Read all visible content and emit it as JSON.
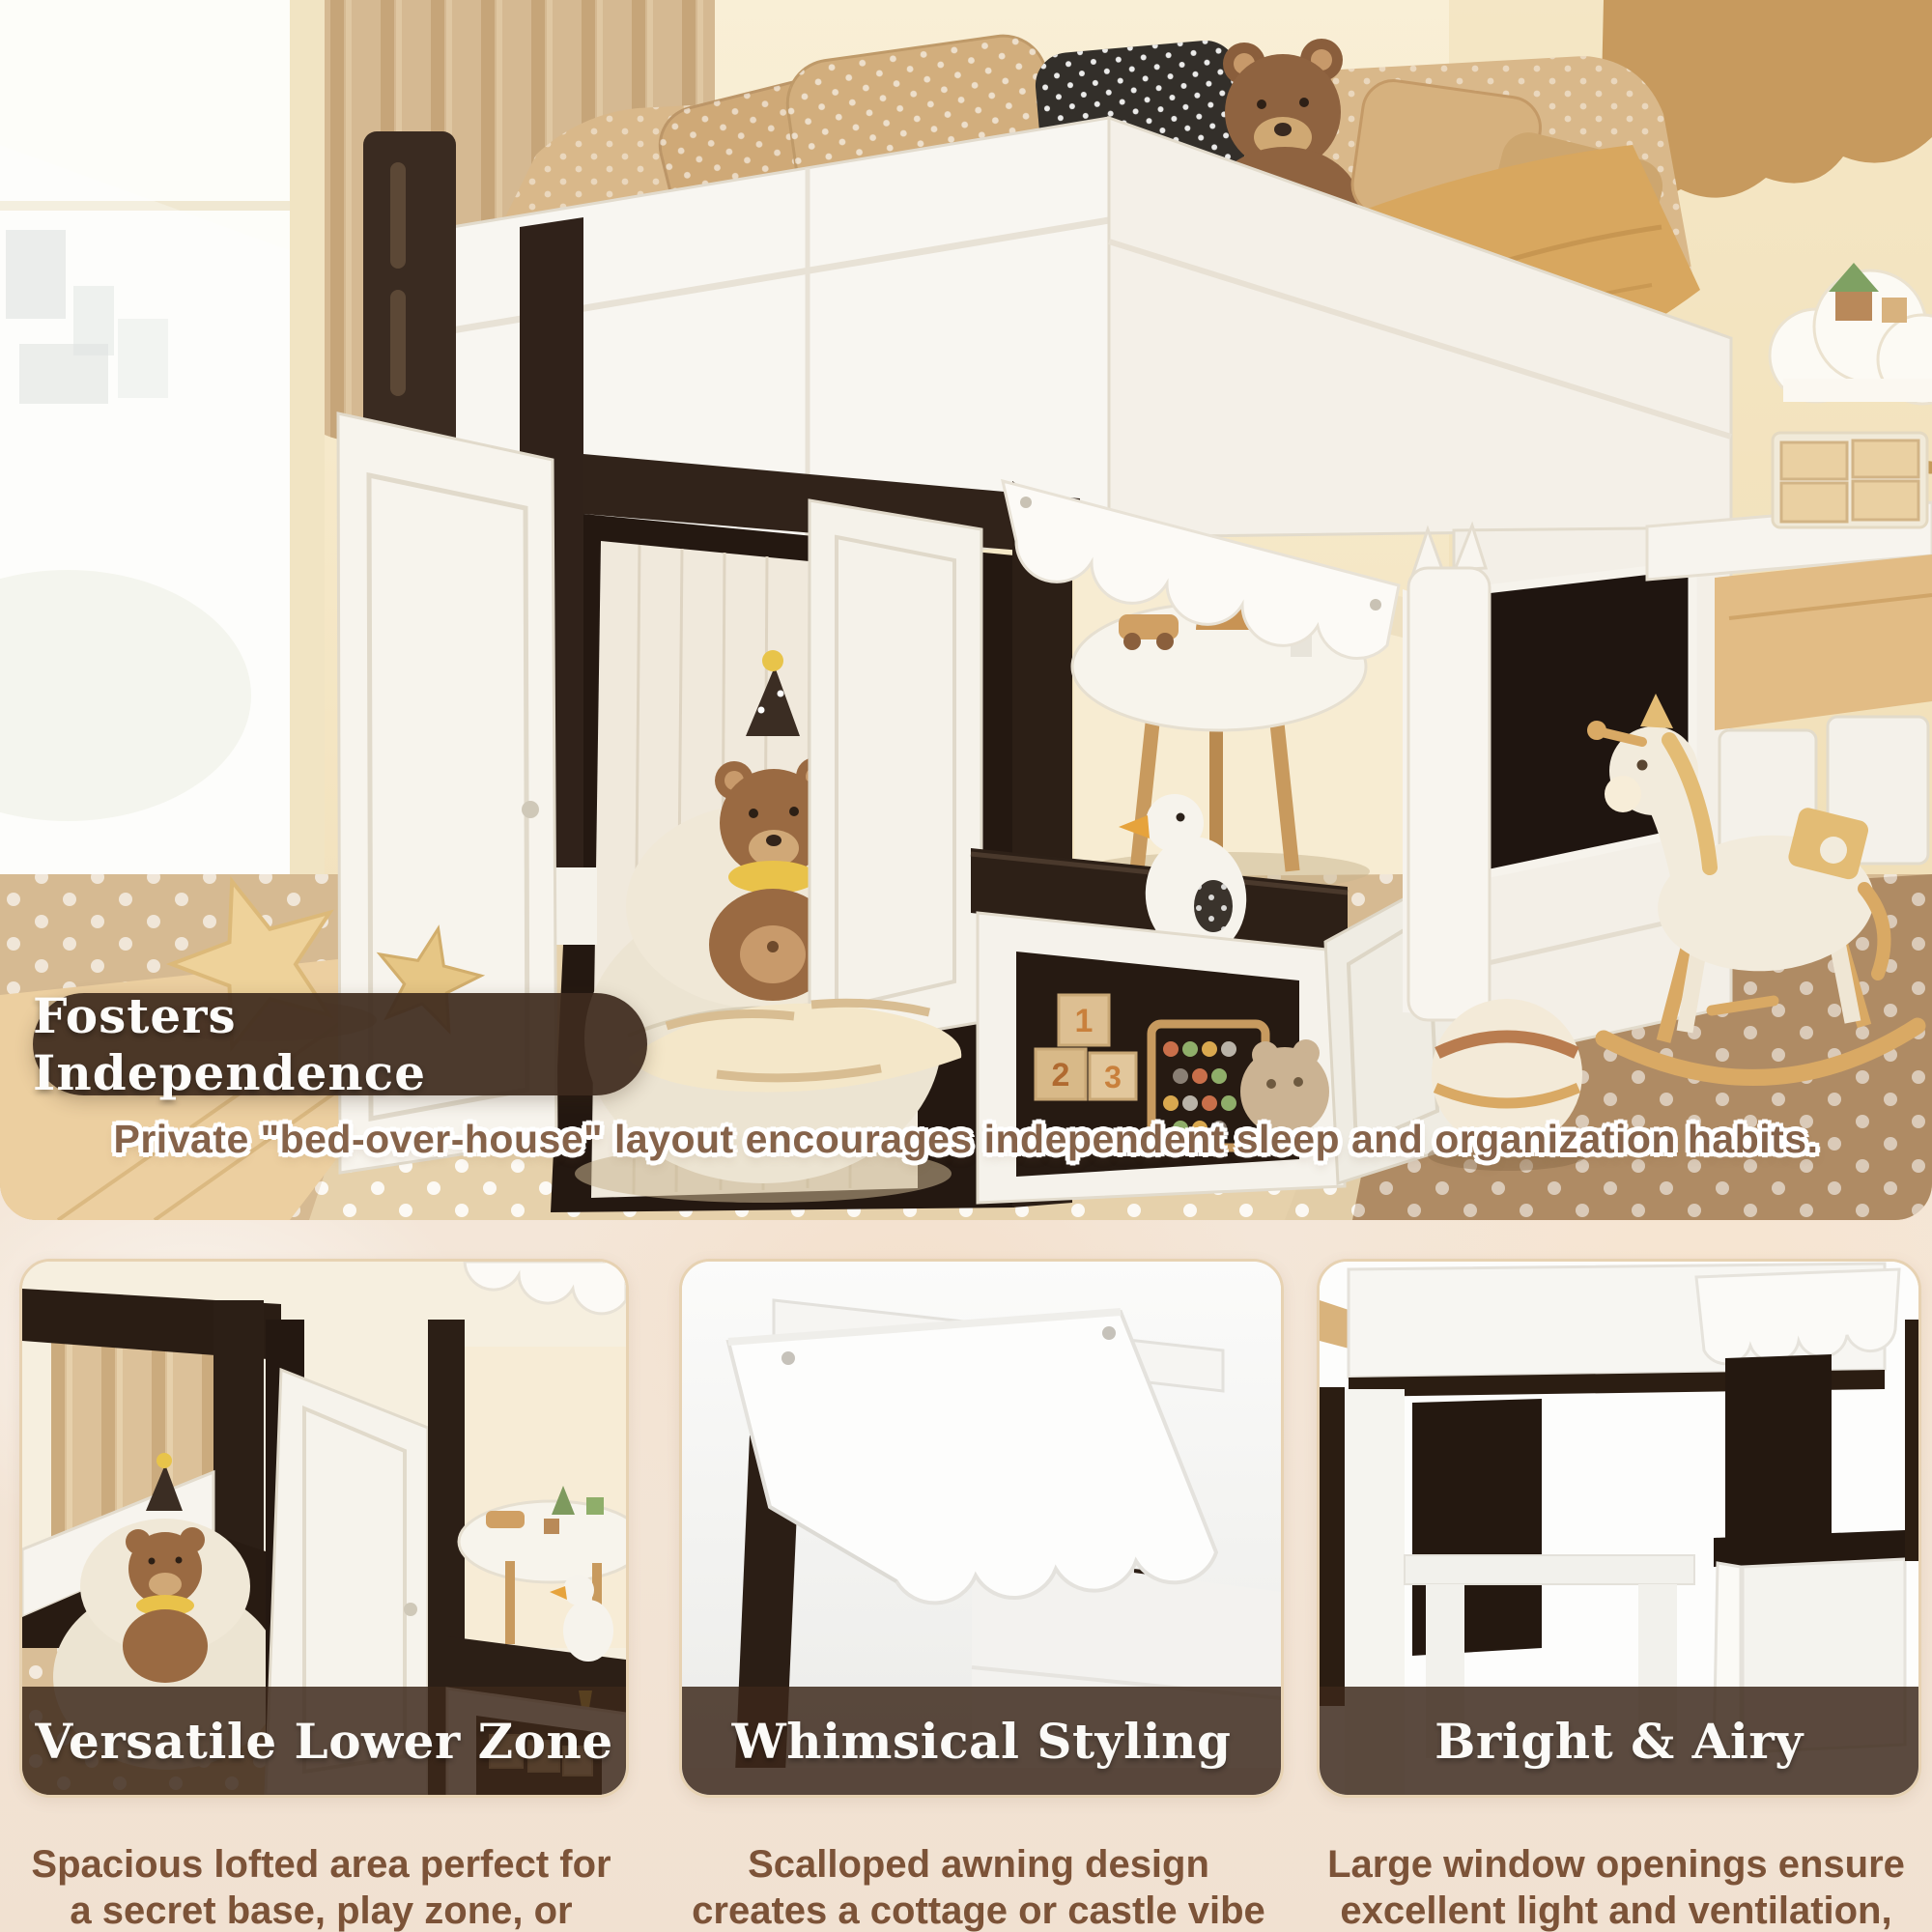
{
  "hero": {
    "badge": "Fosters Independence",
    "caption": "Private \"bed-over-house\" layout encourages independent sleep and organization habits."
  },
  "toy_block_numbers": [
    "1",
    "2",
    "3"
  ],
  "cards": [
    {
      "title": "Versatile Lower Zone",
      "description": "Spacious lofted area perfect for a secret base, play zone, or reading nook."
    },
    {
      "title": "Whimsical Styling",
      "description": "Scalloped awning design creates a cottage or castle vibe to spark imagination."
    },
    {
      "title": "Bright & Airy",
      "description": "Large window openings ensure excellent light and ventilation, preventing a cramped feel."
    }
  ],
  "colors": {
    "badge_bg": "#3e2b1e",
    "title_band_bg": "#3c271a",
    "caption_text": "#86634a",
    "description_text": "#7c5338",
    "section_bg": "#f6ecdf",
    "card_border": "#e7d2b2",
    "dark_wood": "#32241a",
    "carpet": "#d6ba92"
  }
}
